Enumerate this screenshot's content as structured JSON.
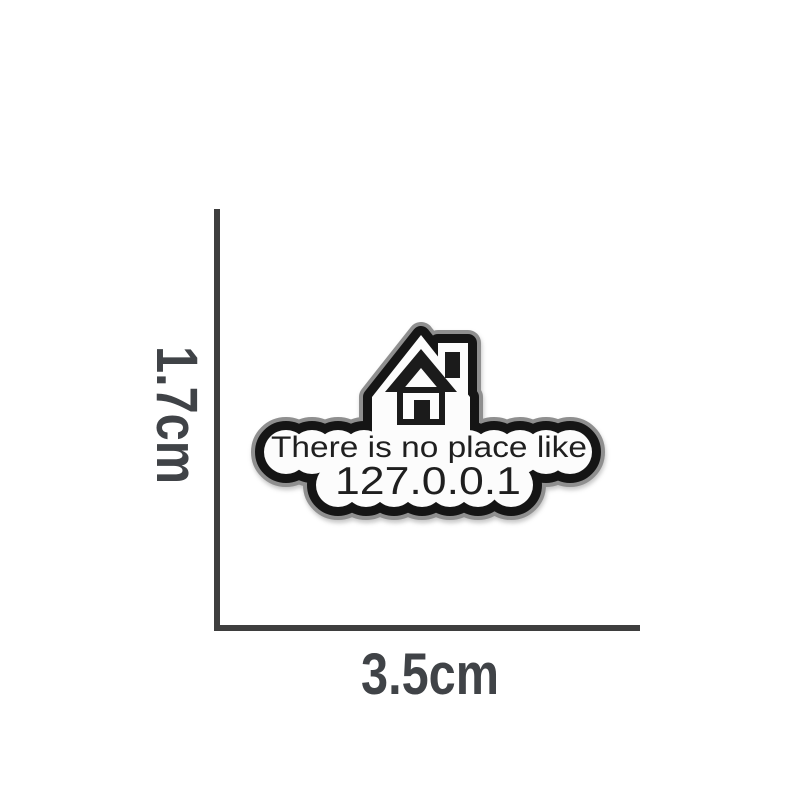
{
  "page": {
    "background": "#ffffff"
  },
  "pin": {
    "kind": "enamel pin product photo",
    "icon": "house",
    "text_line1": "There is no place like",
    "text_line2": "127.0.0.1",
    "colors": {
      "rim": "#8f8f8f",
      "edge": "#151515",
      "enamel": "#fcfcfc",
      "artwork": "#1b1b1b",
      "text": "#1f1f1f"
    }
  },
  "dimensions": {
    "height": {
      "label": "1.7cm"
    },
    "width": {
      "label": "3.5cm"
    },
    "line_color": "#3e3e3e",
    "label_color": "#404347"
  }
}
